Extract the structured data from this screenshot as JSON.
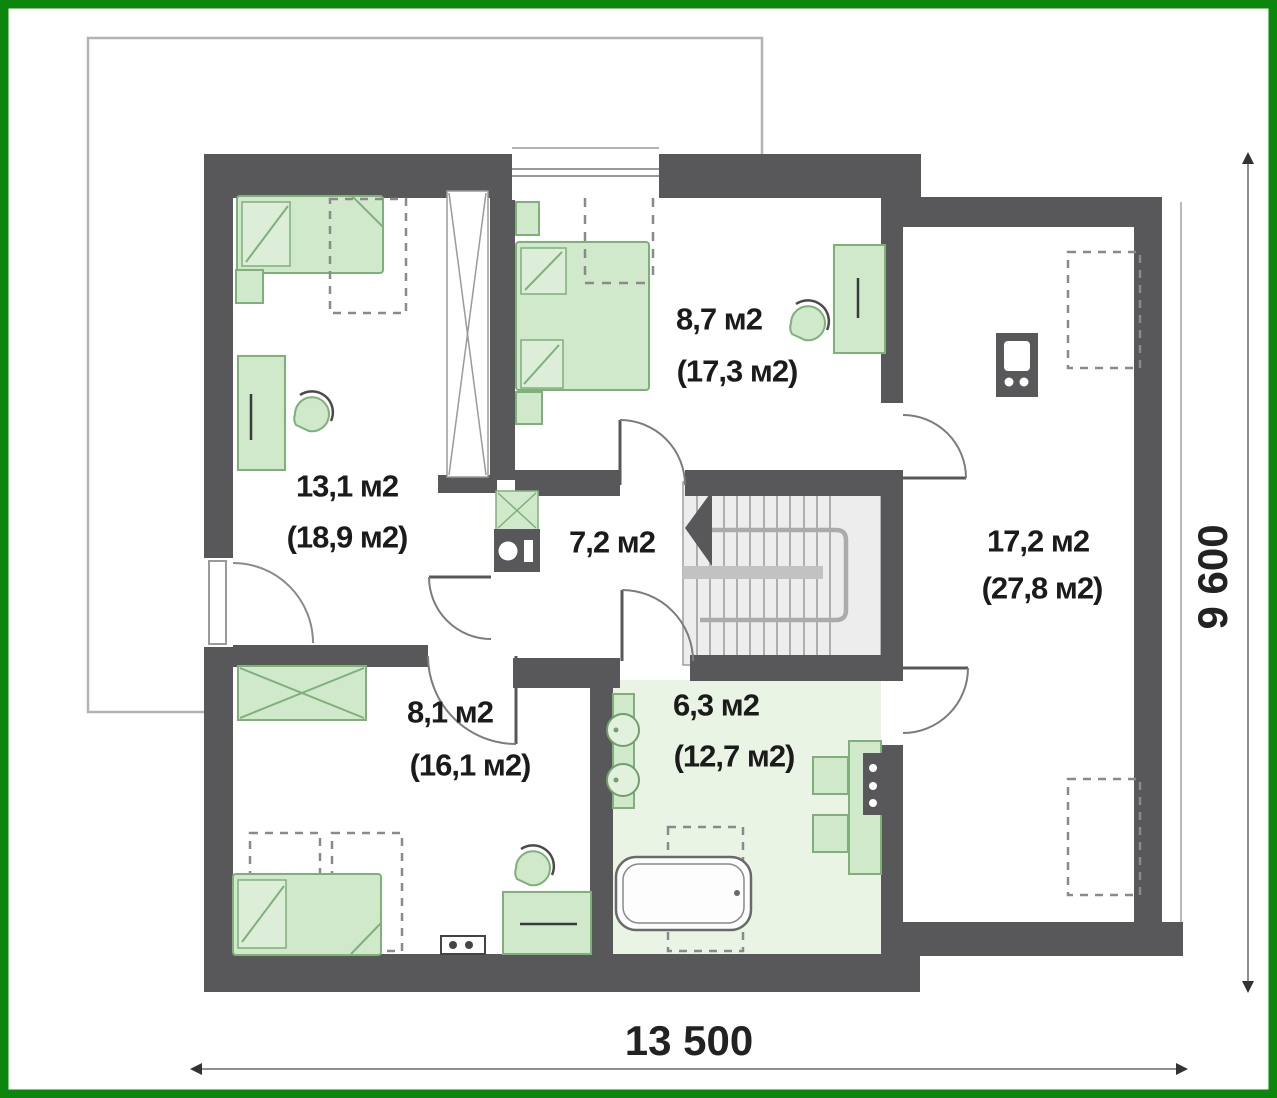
{
  "document": {
    "kind": "floor-plan",
    "floor": "attic-level"
  },
  "rooms": [
    {
      "name": "bedroom-upper-left",
      "area_label": "13,1 м2",
      "area_total": "(18,9 м2)"
    },
    {
      "name": "bedroom-upper-middle",
      "area_label": "8,7 м2",
      "area_total": "(17,3 м2)"
    },
    {
      "name": "hallway",
      "area_label": "7,2 м2",
      "area_total": ""
    },
    {
      "name": "attic-room-right",
      "area_label": "17,2 м2",
      "area_total": "(27,8 м2)"
    },
    {
      "name": "bedroom-lower-left",
      "area_label": "8,1 м2",
      "area_total": "(16,1 м2)"
    },
    {
      "name": "bathroom",
      "area_label": "6,3 м2",
      "area_total": "(12,7 м2)"
    }
  ],
  "dimensions": {
    "width_label": "13 500",
    "height_label": "9 600"
  },
  "colors": {
    "frame_green": "#0c860c",
    "wall_gray": "#58575a",
    "furniture_green_fill": "#cfe9ca",
    "furniture_green_stroke": "#7fb07a",
    "bathroom_floor": "#e9f4e4",
    "stairs_fill": "#ededed",
    "dashed_gray": "#8a8a8a",
    "roof_outline": "#b3b3b3"
  },
  "icons": [
    "single-bed-icon",
    "double-bed-icon",
    "dashed-bed-option-icon",
    "desk-icon",
    "chair-icon",
    "wardrobe-icon",
    "sliding-wardrobe-icon",
    "stairs-icon",
    "stairs-direction-arrow-icon",
    "washing-machine-icon",
    "sink-icon",
    "bathtub-icon",
    "towel-radiator-icon",
    "chimney-flue-icon",
    "skylight-dashed-icon",
    "door-swing-icon",
    "window-icon",
    "radiator-icon"
  ]
}
